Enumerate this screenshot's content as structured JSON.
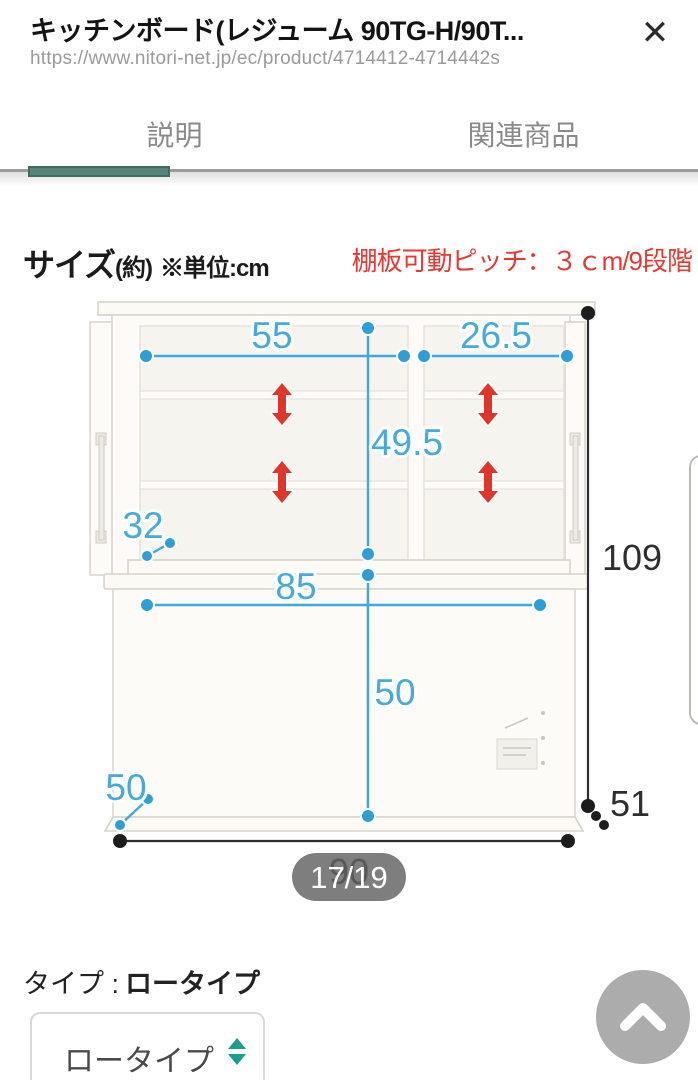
{
  "window": {
    "title": "キッチンボード(レジューム 90TG-H/90T...",
    "url": "https://www.nitori-net.jp/ec/product/4714412-4714442s",
    "close_icon": "✕"
  },
  "tabs": {
    "description": "説明",
    "related": "関連商品"
  },
  "size_section": {
    "heading": "サイズ",
    "approx": "(約)",
    "unit": "※単位:cm",
    "shelf_note": "棚板可動ピッチ：３ｃm/9段階"
  },
  "diagram": {
    "dims": {
      "upper_inner_width_left": "55",
      "upper_inner_width_right": "26.5",
      "upper_inner_height": "49.5",
      "upper_depth": "32",
      "counter_inner_width": "85",
      "lower_height": "50",
      "lower_depth": "50",
      "total_height": "109",
      "total_width": "90",
      "total_depth": "51"
    }
  },
  "pager": {
    "current": "17/19"
  },
  "type_section": {
    "label": "タイプ :",
    "value": "ロータイプ"
  },
  "type_select": {
    "value": "ロータイプ"
  },
  "colors": {
    "dimension_blue": "#3FA9DC",
    "arrow_red": "#E0352B",
    "note_red": "#E8382F",
    "tab_indicator_teal": "#57837A",
    "select_arrow_teal": "#1C9E8E"
  }
}
